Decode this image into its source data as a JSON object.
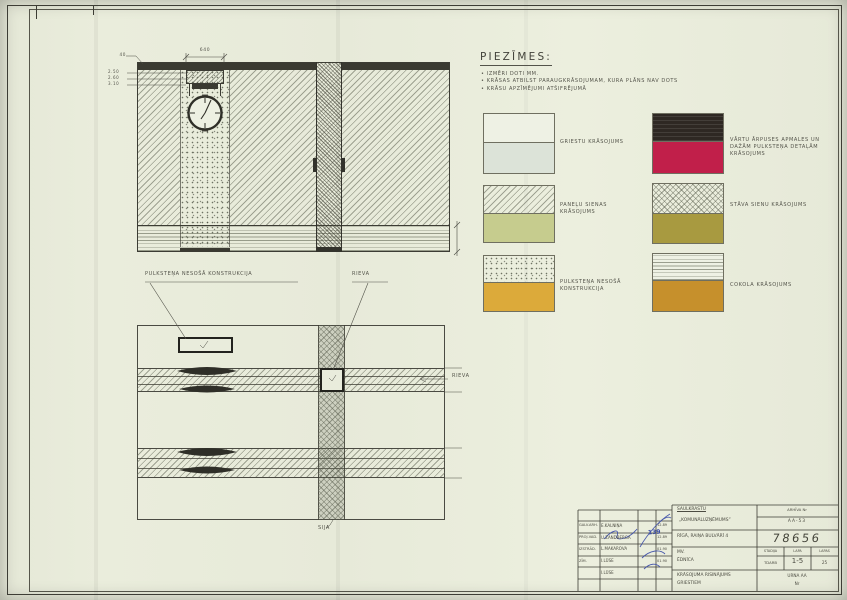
{
  "sheet": {
    "paper_color": "#e9ecdc",
    "ink_color": "#3f3f37",
    "signature_ink": "#3b4da8"
  },
  "notes": {
    "title": "PIEZĪMES:",
    "items": [
      "IZMĒRI DOTI MM.",
      "KRĀSAS ATBILST PARAUGKRĀSOJUMAM, KURA PLĀNS NAV DOTS",
      "KRĀSU APZĪMĒJUMI ATŠIFRĒJUMĀ"
    ]
  },
  "legend": {
    "left": [
      {
        "label": "GRIESTU KRĀSOJUMS",
        "color": "#dce3d8"
      },
      {
        "label": "PANEĻU SIENAS KRĀSOJUMS",
        "color": "#c6cc8e"
      },
      {
        "label": "PULKSTEŅA NESOŠĀ KONSTRUKCIJA",
        "color": "#dcaa3a"
      }
    ],
    "right": [
      {
        "label": "VĀRTU ĀRPUSES APMALES UN DAŽĀM PULKSTEŅA DETAĻĀM KRĀSOJUMS",
        "color": "#c11f4a",
        "top_color": "#2e2823"
      },
      {
        "label": "STĀVA SIENU KRĀSOJUMS",
        "color": "#a89a40"
      },
      {
        "label": "COKOLA KRĀSOJUMS",
        "color": "#c6902c"
      }
    ]
  },
  "drawing": {
    "upper": {
      "dim_top": "640",
      "dim_topleft": "40",
      "levels": [
        "2.50",
        "2.60",
        "3.10"
      ],
      "callout_left": "PULKSTEŅA NESOŠĀ KONSTRUKCIJA",
      "callout_right": "RIEVA"
    },
    "plan": {
      "label_right": "RIEVA",
      "label_bottom": "SIJA"
    }
  },
  "titleblock": {
    "org_line1": "SAULKRASTU",
    "org_line2": "„KOMUNĀLUZŅĒMUMS”",
    "archive_label": "ARHĪVA Nr",
    "archive_no": "AA-53",
    "address": "RĪGĀ, RAIŅA BULVĀRĪ 4",
    "drawing_no": "78656",
    "object_line1": "MV.",
    "object_line2": "ĒDNĪCA",
    "stage_label": "STADIJA",
    "sheet_label": "LAPA",
    "sheets_label": "LAPAS",
    "stage_value": "TDARB",
    "sheet_value": "1-5",
    "sheets_value": "25",
    "subject_line1": "KRĀSOJUMA RISINĀJUMS",
    "subject_line2": "GRIESTIEM",
    "group_line1": "URNA AA",
    "group_line2": "Nr",
    "stamp": "139",
    "rows": [
      {
        "role": "GALV.ARH.",
        "name": "E.KALNIŅA",
        "date": "12.89"
      },
      {
        "role": "PROJ.VAD.",
        "name": "U.ZANDBERGA",
        "date": "12.89"
      },
      {
        "role": "IZSTRĀD.",
        "name": "L.MAKAROVA",
        "date": "01.90"
      },
      {
        "role": "ZĪM.",
        "name": "I.LŪSE",
        "date": "01.90"
      },
      {
        "role": "",
        "name": "I.LŪSE",
        "date": ""
      }
    ]
  }
}
